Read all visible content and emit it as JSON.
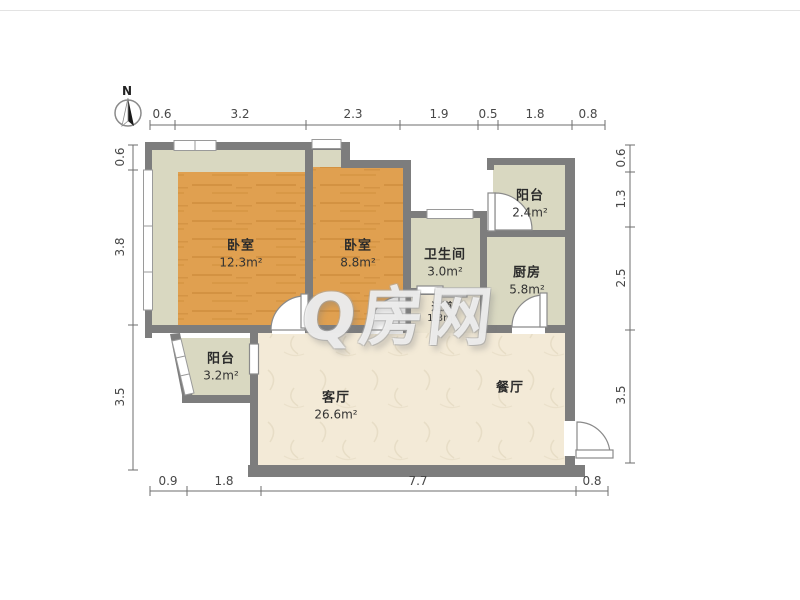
{
  "compass": {
    "label": "N"
  },
  "watermark": {
    "text": "Q房网"
  },
  "rooms": {
    "bedroom_left": {
      "name": "卧室",
      "area": "12.3m²"
    },
    "bedroom_mid": {
      "name": "卧室",
      "area": "8.8m²"
    },
    "bathroom": {
      "name": "卫生间",
      "area": "3.0m²"
    },
    "hallway": {
      "name": "过道",
      "area": "1.3m²"
    },
    "balcony_top": {
      "name": "阳台",
      "area": "2.4m²"
    },
    "kitchen": {
      "name": "厨房",
      "area": "5.8m²"
    },
    "balcony_left": {
      "name": "阳台",
      "area": "3.2m²"
    },
    "living": {
      "name": "客厅",
      "area": "26.6m²"
    },
    "dining": {
      "name": "餐厅"
    }
  },
  "dimensions": {
    "top": [
      "0.6",
      "3.2",
      "2.3",
      "1.9",
      "0.5",
      "1.8",
      "0.8"
    ],
    "bottom": [
      "0.9",
      "1.8",
      "7.7",
      "0.8"
    ],
    "left": [
      "0.6",
      "3.8",
      "3.5"
    ],
    "right": [
      "0.6",
      "1.3",
      "2.5",
      "3.5"
    ]
  },
  "colors": {
    "wall": "#7d7d7d",
    "wood_floor": "#e0a050",
    "tile_floor": "#d9d8c1",
    "living_floor": "#f3ead7",
    "dimension_text": "#474747",
    "background": "#ffffff"
  }
}
